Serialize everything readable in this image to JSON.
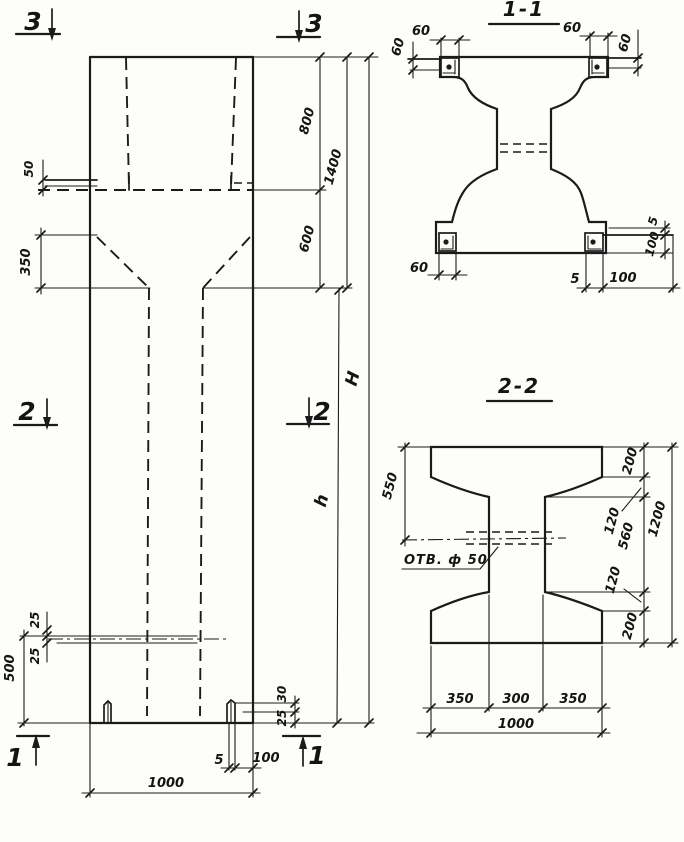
{
  "elevation": {
    "marks": {
      "top_left": "3",
      "top_right": "3",
      "mid_left": "2",
      "mid_right": "2",
      "bottom_left": "1",
      "bottom_right": "1"
    },
    "dims": {
      "plate_50": "50",
      "taper_350": "350",
      "top_800": "800",
      "top_1400": "1400",
      "top_600": "600",
      "height_H": "H",
      "height_h": "h",
      "hole_25_top": "25",
      "hole_25_bottom": "25",
      "bottom_500": "500",
      "foot_30": "30",
      "foot_25": "25",
      "base_5": "5",
      "base_100": "100",
      "width_1000": "1000"
    }
  },
  "section_1_1": {
    "title": "1-1",
    "dims": {
      "top_left_60": "60",
      "left_60": "60",
      "top_right_60": "60",
      "right_60": "60",
      "bottom_left_60": "60",
      "bottom_5": "5",
      "bottom_100": "100",
      "side_5": "5",
      "side_100": "100"
    }
  },
  "section_2_2": {
    "title": "2-2",
    "hole_label": "ОТВ. ф 50",
    "dims": {
      "left_550": "550",
      "right_200_top": "200",
      "right_120_top": "120",
      "right_560": "560",
      "right_120_bottom": "120",
      "right_200_bottom": "200",
      "right_1200": "1200",
      "bottom_350_left": "350",
      "bottom_300": "300",
      "bottom_350_right": "350",
      "bottom_1000": "1000"
    }
  }
}
